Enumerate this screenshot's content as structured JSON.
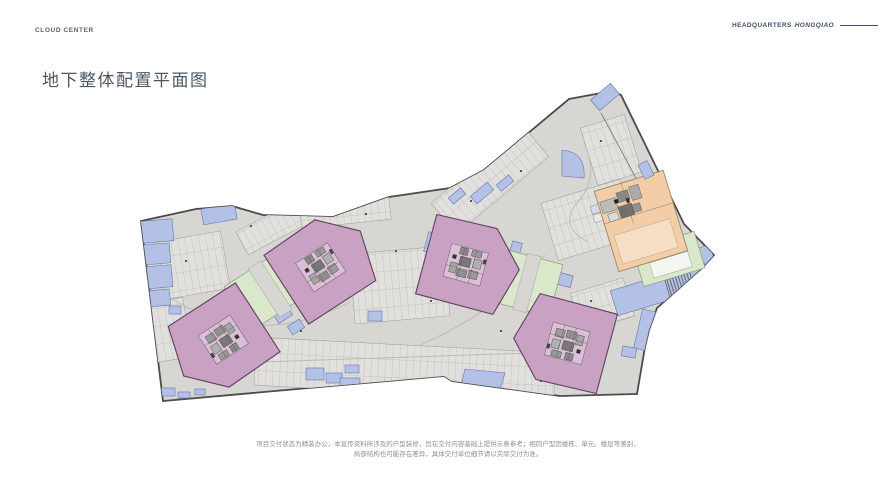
{
  "header": {
    "brand_left": "CLOUD CENTER",
    "brand_right": "HEADQUARTERS",
    "brand_right_em": "HONGQIAO"
  },
  "title": "地下整体配置平面图",
  "disclaimer": {
    "line1": "项目交付状态为精装办公，本宣传资料所涉及的户型装修，旨在交付内容基础上提供示意参考；相同户型因楼栋、单元、楼层等差别，",
    "line2": "局部结构也可能存在差异，具体交付单位细节请以实际交付为准。"
  },
  "plan": {
    "colors": {
      "floor": "#d7d6d2",
      "outline": "#4b4b4b",
      "tower_pink": "#c9a1c3",
      "tower_edge": "#5d4060",
      "green_space": "#d9e7cb",
      "hq_orange": "#f2cda8",
      "stair_blue": "#b4c1e7",
      "stair_edge": "#6474a8"
    }
  }
}
